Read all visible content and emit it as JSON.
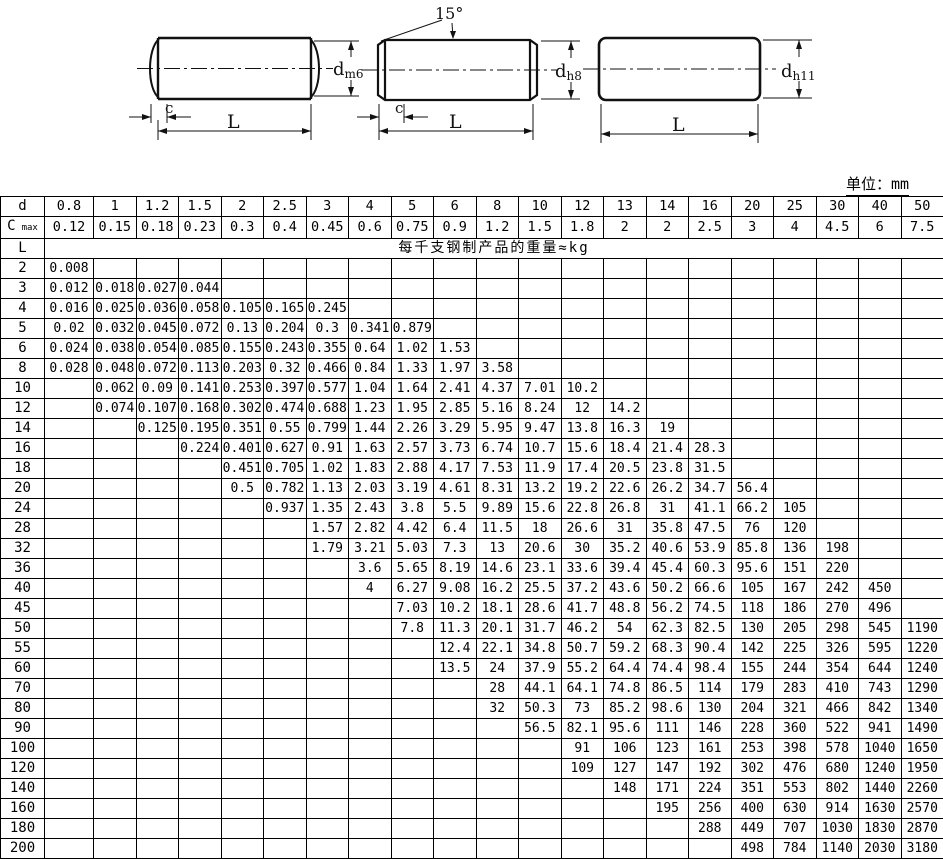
{
  "unit_label": "单位：mm",
  "diagrams": {
    "pin1": {
      "d": "d",
      "d_sub": "m6",
      "c": "c",
      "L": "L"
    },
    "pin2": {
      "angle": "15°",
      "d": "d",
      "d_sub": "h8",
      "c": "c",
      "L": "L"
    },
    "pin3": {
      "d": "d",
      "d_sub": "h11",
      "L": "L"
    }
  },
  "table": {
    "d_label": "d",
    "c_label": "C",
    "c_sub": "max",
    "l_label": "L",
    "weight_header": "每千支钢制产品的重量≈kg",
    "d_values": [
      "0.8",
      "1",
      "1.2",
      "1.5",
      "2",
      "2.5",
      "3",
      "4",
      "5",
      "6",
      "8",
      "10",
      "12",
      "13",
      "14",
      "16",
      "20",
      "25",
      "30",
      "40",
      "50"
    ],
    "c_values": [
      "0.12",
      "0.15",
      "0.18",
      "0.23",
      "0.3",
      "0.4",
      "0.45",
      "0.6",
      "0.75",
      "0.9",
      "1.2",
      "1.5",
      "1.8",
      "2",
      "2",
      "2.5",
      "3",
      "4",
      "4.5",
      "6",
      "7.5"
    ],
    "rows": [
      {
        "L": "2",
        "v": [
          "0.008",
          "",
          "",
          "",
          "",
          "",
          "",
          "",
          "",
          "",
          "",
          "",
          "",
          "",
          "",
          "",
          "",
          "",
          "",
          "",
          ""
        ]
      },
      {
        "L": "3",
        "v": [
          "0.012",
          "0.018",
          "0.027",
          "0.044",
          "",
          "",
          "",
          "",
          "",
          "",
          "",
          "",
          "",
          "",
          "",
          "",
          "",
          "",
          "",
          "",
          ""
        ]
      },
      {
        "L": "4",
        "v": [
          "0.016",
          "0.025",
          "0.036",
          "0.058",
          "0.105",
          "0.165",
          "0.245",
          "",
          "",
          "",
          "",
          "",
          "",
          "",
          "",
          "",
          "",
          "",
          "",
          "",
          ""
        ]
      },
      {
        "L": "5",
        "v": [
          "0.02",
          "0.032",
          "0.045",
          "0.072",
          "0.13",
          "0.204",
          "0.3",
          "0.341",
          "0.879",
          "",
          "",
          "",
          "",
          "",
          "",
          "",
          "",
          "",
          "",
          "",
          ""
        ]
      },
      {
        "L": "6",
        "v": [
          "0.024",
          "0.038",
          "0.054",
          "0.085",
          "0.155",
          "0.243",
          "0.355",
          "0.64",
          "1.02",
          "1.53",
          "",
          "",
          "",
          "",
          "",
          "",
          "",
          "",
          "",
          "",
          ""
        ]
      },
      {
        "L": "8",
        "v": [
          "0.028",
          "0.048",
          "0.072",
          "0.113",
          "0.203",
          "0.32",
          "0.466",
          "0.84",
          "1.33",
          "1.97",
          "3.58",
          "",
          "",
          "",
          "",
          "",
          "",
          "",
          "",
          "",
          ""
        ]
      },
      {
        "L": "10",
        "v": [
          "",
          "0.062",
          "0.09",
          "0.141",
          "0.253",
          "0.397",
          "0.577",
          "1.04",
          "1.64",
          "2.41",
          "4.37",
          "7.01",
          "10.2",
          "",
          "",
          "",
          "",
          "",
          "",
          "",
          ""
        ]
      },
      {
        "L": "12",
        "v": [
          "",
          "0.074",
          "0.107",
          "0.168",
          "0.302",
          "0.474",
          "0.688",
          "1.23",
          "1.95",
          "2.85",
          "5.16",
          "8.24",
          "12",
          "14.2",
          "",
          "",
          "",
          "",
          "",
          "",
          ""
        ]
      },
      {
        "L": "14",
        "v": [
          "",
          "",
          "0.125",
          "0.195",
          "0.351",
          "0.55",
          "0.799",
          "1.44",
          "2.26",
          "3.29",
          "5.95",
          "9.47",
          "13.8",
          "16.3",
          "19",
          "",
          "",
          "",
          "",
          "",
          ""
        ]
      },
      {
        "L": "16",
        "v": [
          "",
          "",
          "",
          "0.224",
          "0.401",
          "0.627",
          "0.91",
          "1.63",
          "2.57",
          "3.73",
          "6.74",
          "10.7",
          "15.6",
          "18.4",
          "21.4",
          "28.3",
          "",
          "",
          "",
          "",
          ""
        ]
      },
      {
        "L": "18",
        "v": [
          "",
          "",
          "",
          "",
          "0.451",
          "0.705",
          "1.02",
          "1.83",
          "2.88",
          "4.17",
          "7.53",
          "11.9",
          "17.4",
          "20.5",
          "23.8",
          "31.5",
          "",
          "",
          "",
          "",
          ""
        ]
      },
      {
        "L": "20",
        "v": [
          "",
          "",
          "",
          "",
          "0.5",
          "0.782",
          "1.13",
          "2.03",
          "3.19",
          "4.61",
          "8.31",
          "13.2",
          "19.2",
          "22.6",
          "26.2",
          "34.7",
          "56.4",
          "",
          "",
          "",
          ""
        ]
      },
      {
        "L": "24",
        "v": [
          "",
          "",
          "",
          "",
          "",
          "0.937",
          "1.35",
          "2.43",
          "3.8",
          "5.5",
          "9.89",
          "15.6",
          "22.8",
          "26.8",
          "31",
          "41.1",
          "66.2",
          "105",
          "",
          "",
          ""
        ]
      },
      {
        "L": "28",
        "v": [
          "",
          "",
          "",
          "",
          "",
          "",
          "1.57",
          "2.82",
          "4.42",
          "6.4",
          "11.5",
          "18",
          "26.6",
          "31",
          "35.8",
          "47.5",
          "76",
          "120",
          "",
          "",
          ""
        ]
      },
      {
        "L": "32",
        "v": [
          "",
          "",
          "",
          "",
          "",
          "",
          "1.79",
          "3.21",
          "5.03",
          "7.3",
          "13",
          "20.6",
          "30",
          "35.2",
          "40.6",
          "53.9",
          "85.8",
          "136",
          "198",
          "",
          ""
        ]
      },
      {
        "L": "36",
        "v": [
          "",
          "",
          "",
          "",
          "",
          "",
          "",
          "3.6",
          "5.65",
          "8.19",
          "14.6",
          "23.1",
          "33.6",
          "39.4",
          "45.4",
          "60.3",
          "95.6",
          "151",
          "220",
          "",
          ""
        ]
      },
      {
        "L": "40",
        "v": [
          "",
          "",
          "",
          "",
          "",
          "",
          "",
          "4",
          "6.27",
          "9.08",
          "16.2",
          "25.5",
          "37.2",
          "43.6",
          "50.2",
          "66.6",
          "105",
          "167",
          "242",
          "450",
          ""
        ]
      },
      {
        "L": "45",
        "v": [
          "",
          "",
          "",
          "",
          "",
          "",
          "",
          "",
          "7.03",
          "10.2",
          "18.1",
          "28.6",
          "41.7",
          "48.8",
          "56.2",
          "74.5",
          "118",
          "186",
          "270",
          "496",
          ""
        ]
      },
      {
        "L": "50",
        "v": [
          "",
          "",
          "",
          "",
          "",
          "",
          "",
          "",
          "7.8",
          "11.3",
          "20.1",
          "31.7",
          "46.2",
          "54",
          "62.3",
          "82.5",
          "130",
          "205",
          "298",
          "545",
          "1190"
        ]
      },
      {
        "L": "55",
        "v": [
          "",
          "",
          "",
          "",
          "",
          "",
          "",
          "",
          "",
          "12.4",
          "22.1",
          "34.8",
          "50.7",
          "59.2",
          "68.3",
          "90.4",
          "142",
          "225",
          "326",
          "595",
          "1220"
        ]
      },
      {
        "L": "60",
        "v": [
          "",
          "",
          "",
          "",
          "",
          "",
          "",
          "",
          "",
          "13.5",
          "24",
          "37.9",
          "55.2",
          "64.4",
          "74.4",
          "98.4",
          "155",
          "244",
          "354",
          "644",
          "1240"
        ]
      },
      {
        "L": "70",
        "v": [
          "",
          "",
          "",
          "",
          "",
          "",
          "",
          "",
          "",
          "",
          "28",
          "44.1",
          "64.1",
          "74.8",
          "86.5",
          "114",
          "179",
          "283",
          "410",
          "743",
          "1290"
        ]
      },
      {
        "L": "80",
        "v": [
          "",
          "",
          "",
          "",
          "",
          "",
          "",
          "",
          "",
          "",
          "32",
          "50.3",
          "73",
          "85.2",
          "98.6",
          "130",
          "204",
          "321",
          "466",
          "842",
          "1340"
        ]
      },
      {
        "L": "90",
        "v": [
          "",
          "",
          "",
          "",
          "",
          "",
          "",
          "",
          "",
          "",
          "",
          "56.5",
          "82.1",
          "95.6",
          "111",
          "146",
          "228",
          "360",
          "522",
          "941",
          "1490"
        ]
      },
      {
        "L": "100",
        "v": [
          "",
          "",
          "",
          "",
          "",
          "",
          "",
          "",
          "",
          "",
          "",
          "",
          "91",
          "106",
          "123",
          "161",
          "253",
          "398",
          "578",
          "1040",
          "1650"
        ]
      },
      {
        "L": "120",
        "v": [
          "",
          "",
          "",
          "",
          "",
          "",
          "",
          "",
          "",
          "",
          "",
          "",
          "109",
          "127",
          "147",
          "192",
          "302",
          "476",
          "680",
          "1240",
          "1950"
        ]
      },
      {
        "L": "140",
        "v": [
          "",
          "",
          "",
          "",
          "",
          "",
          "",
          "",
          "",
          "",
          "",
          "",
          "",
          "148",
          "171",
          "224",
          "351",
          "553",
          "802",
          "1440",
          "2260"
        ]
      },
      {
        "L": "160",
        "v": [
          "",
          "",
          "",
          "",
          "",
          "",
          "",
          "",
          "",
          "",
          "",
          "",
          "",
          "",
          "195",
          "256",
          "400",
          "630",
          "914",
          "1630",
          "2570"
        ]
      },
      {
        "L": "180",
        "v": [
          "",
          "",
          "",
          "",
          "",
          "",
          "",
          "",
          "",
          "",
          "",
          "",
          "",
          "",
          "",
          "288",
          "449",
          "707",
          "1030",
          "1830",
          "2870"
        ]
      },
      {
        "L": "200",
        "v": [
          "",
          "",
          "",
          "",
          "",
          "",
          "",
          "",
          "",
          "",
          "",
          "",
          "",
          "",
          "",
          "",
          "498",
          "784",
          "1140",
          "2030",
          "3180"
        ]
      }
    ]
  }
}
